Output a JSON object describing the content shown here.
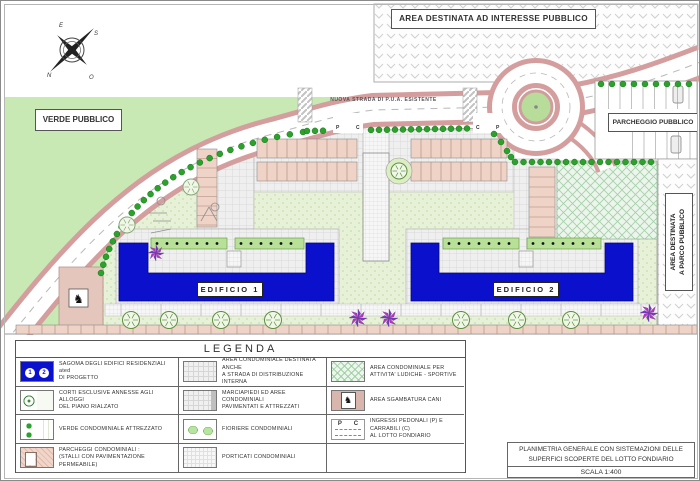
{
  "plan": {
    "labels": {
      "area_interesse": "AREA DESTINATA AD INTERESSE PUBBLICO",
      "verde_pubblico": "VERDE PUBBLICO",
      "parcheggio_pubblico": "PARCHEGGIO PUBBLICO",
      "area_parco_line1": "AREA DESTINATA",
      "area_parco_line2": "A PARCO PUBBLICO",
      "strada": "NUOVA STRADA DI P.U.A. ESISTENTE",
      "edificio1": "EDIFICIO  1",
      "edificio2": "EDIFICIO  2"
    },
    "entrance_markers": [
      "P",
      "C",
      "C",
      "P"
    ],
    "compass": {
      "top": "E",
      "right": "S",
      "bottom_left": "N",
      "bottom_right": "O"
    }
  },
  "icons": {
    "dog": "♞"
  },
  "legend": {
    "title": "LEGENDA",
    "items": [
      {
        "swatch": "building",
        "line1": "SAGOMA DEGLI EDIFICI RESIDENZIALI",
        "line2": "DI PROGETTO",
        "markers": [
          "1",
          "2"
        ]
      },
      {
        "swatch": "corti",
        "line1": "CORTI ESCLUSIVE ANNESSE AGLI ALLOGGI",
        "line2": "DEL PIANO RIALZATO"
      },
      {
        "swatch": "verde",
        "line1": "VERDE CONDOMINIALE ATTREZZATO",
        "line2": ""
      },
      {
        "swatch": "parcheggi",
        "line1": "PARCHEGGI CONDOMINIALI :",
        "line2": "(STALLI CON PAVIMENTAZIONE PERMEABILE)"
      },
      {
        "swatch": "strada-interna",
        "line1": "AREA CONDOMINIALE DESTINATA ANCHE",
        "line2": "A STRADA DI DISTRIBUZIONE INTERNA"
      },
      {
        "swatch": "marciapiedi",
        "line1": "MARCIAPIEDI ED AREE CONDOMINIALI",
        "line2": "PAVIMENTATI E ATTREZZATI"
      },
      {
        "swatch": "fioriere",
        "line1": "FIORIERE CONDOMINIALI",
        "line2": ""
      },
      {
        "swatch": "porticati",
        "line1": "PORTICATI CONDOMINIALI",
        "line2": ""
      },
      {
        "swatch": "ludiche",
        "line1": "AREA CONDOMINIALE PER",
        "line2": "ATTIVITA' LUDICHE - SPORTIVE"
      },
      {
        "swatch": "cani",
        "line1": "AREA SGAMBATURA CANI",
        "line2": ""
      },
      {
        "swatch": "ingressi",
        "line1": "INGRESSI PEDONALI (P) E CARRABILI (C)",
        "line2": "AL LOTTO FONDIARIO",
        "letters": [
          "P",
          "C"
        ]
      }
    ]
  },
  "title_block": {
    "line1": "PLANIMETRIA GENERALE CON SISTEMAZIONI DELLE",
    "line2": "SUPERFICI SCOPERTE DEL LOTTO FONDIARIO",
    "scale": "SCALA 1:400"
  },
  "colors": {
    "building_blue": "#0b10cc",
    "public_green": "#c9e9b4",
    "road_edge_pink": "#d49e9e",
    "stall_pink": "#efd3c6",
    "hedge_green": "#2da12d",
    "shrub_magenta": "#bb33bb"
  }
}
